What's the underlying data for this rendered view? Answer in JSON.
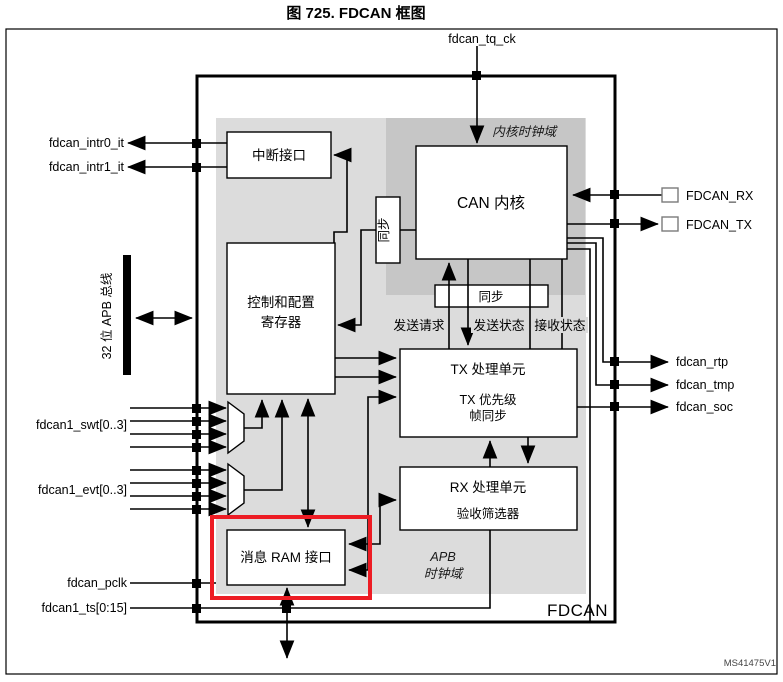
{
  "figure": {
    "title": "图 725. FDCAN 框图",
    "code": "MS41475V1",
    "block_name": "FDCAN"
  },
  "colors": {
    "highlight_red": "#ed1c24",
    "domain_light": "#dcdcdc",
    "domain_dark": "#c6c6c6",
    "line_black": "#000000"
  },
  "signals_left": {
    "intr0": "fdcan_intr0_it",
    "intr1": "fdcan_intr1_it",
    "apb_bus": "32 位 APB 总线",
    "swt": "fdcan1_swt[0..3]",
    "evt": "fdcan1_evt[0..3]",
    "pclk": "fdcan_pclk",
    "ts": "fdcan1_ts[0:15]"
  },
  "signals_top": {
    "tq_ck": "fdcan_tq_ck"
  },
  "signals_right": {
    "rx": "FDCAN_RX",
    "tx": "FDCAN_TX",
    "rtp": "fdcan_rtp",
    "tmp": "fdcan_tmp",
    "soc": "fdcan_soc"
  },
  "blocks": {
    "interrupt": "中断接口",
    "ctrl_line1": "控制和配置",
    "ctrl_line2": "寄存器",
    "core": "CAN 内核",
    "sync_vertical": "同步",
    "sync_horizontal": "同步",
    "tx_line1": "TX 处理单元",
    "tx_line2": "TX 优先级",
    "tx_line3": "帧同步",
    "rx_line1": "RX 处理单元",
    "rx_line2": "验收筛选器",
    "ram": "消息 RAM 接口"
  },
  "domains": {
    "core_clock": "内核时钟域",
    "apb_line1": "APB",
    "apb_line2": "时钟域"
  },
  "bus_labels": {
    "tx_request": "发送请求",
    "tx_status": "发送状态",
    "rx_status": "接收状态"
  }
}
